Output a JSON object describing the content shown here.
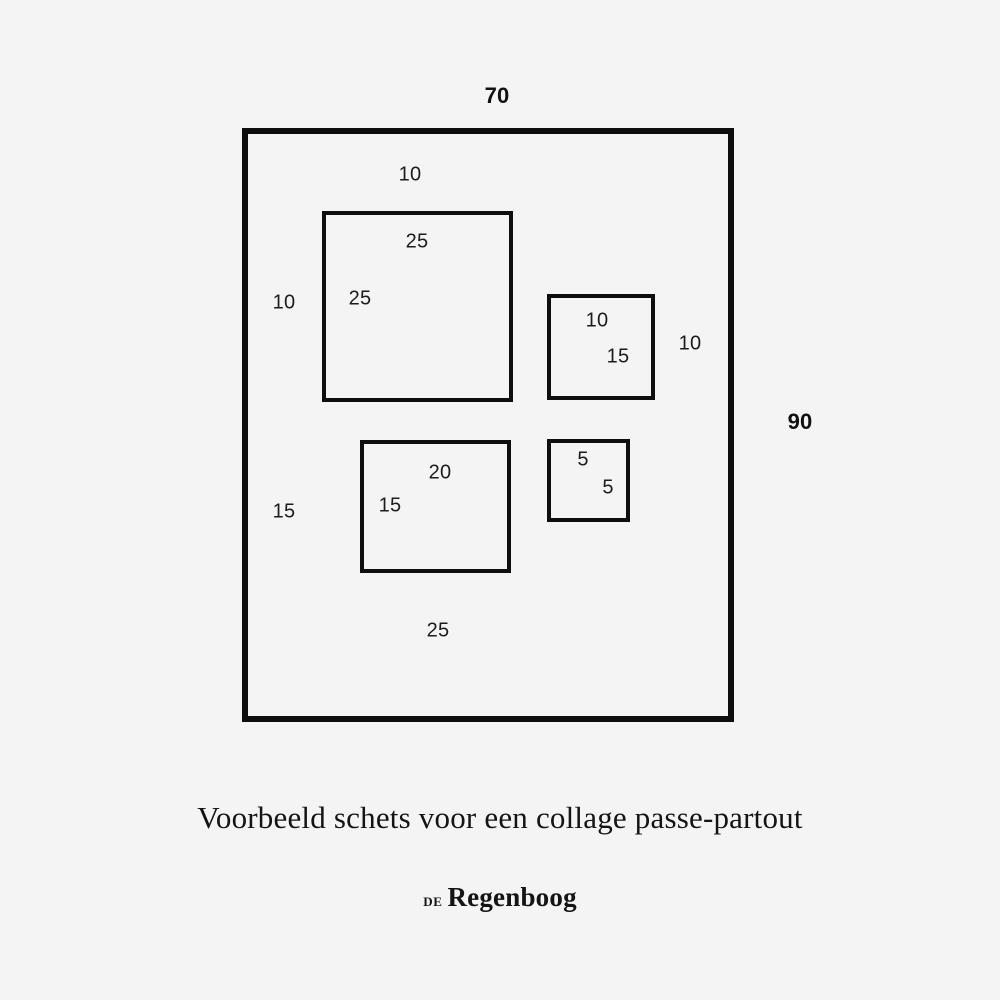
{
  "palette": {
    "background": "#f4f4f4",
    "ink": "#0e0e0e"
  },
  "sketch": {
    "outer_width": "70",
    "outer_height": "90",
    "margins": {
      "top": "10",
      "left_upper": "10",
      "left_lower": "15",
      "right": "10",
      "bottom": "25"
    },
    "openings": [
      {
        "width": "25",
        "height": "25"
      },
      {
        "width": "10",
        "height": "15"
      },
      {
        "width": "20",
        "height": "15"
      },
      {
        "width": "5",
        "height": "5"
      }
    ]
  },
  "caption": "Voorbeeld schets voor een collage passe-partout",
  "logo": {
    "prefix": "DE",
    "name": "Regenboog"
  }
}
